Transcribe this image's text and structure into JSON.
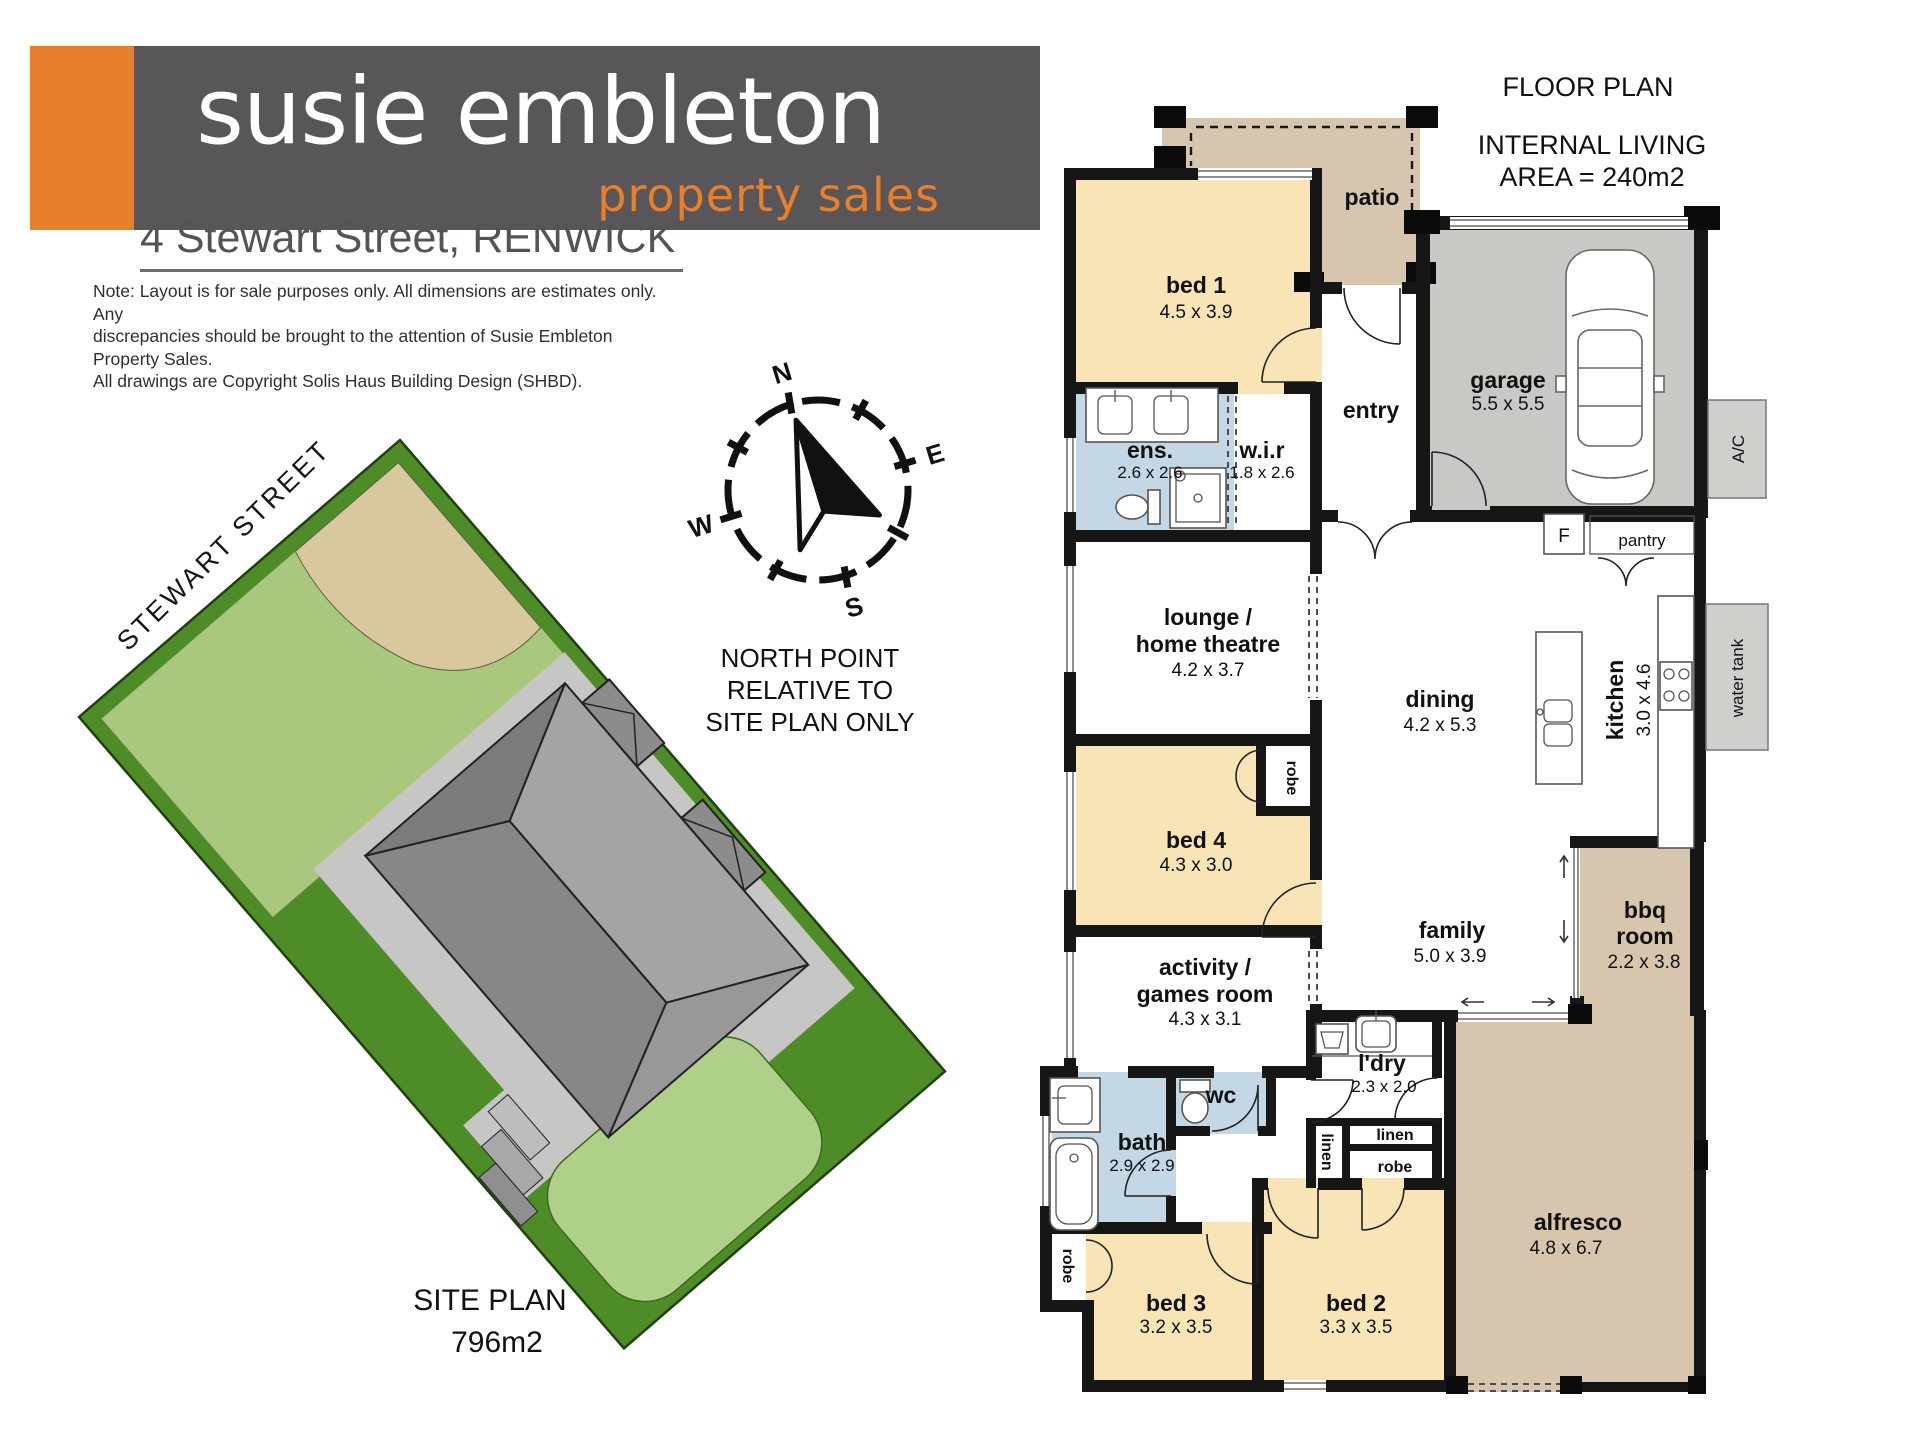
{
  "brand": {
    "line1": "susie embleton",
    "line2": "property sales"
  },
  "address": "4 Stewart Street, RENWICK",
  "note": {
    "line1": "Note: Layout is for sale purposes only. All dimensions are estimates only. Any",
    "line2": "discrepancies should be brought to the attention of Susie Embleton Property Sales.",
    "line3": "All drawings are Copyright Solis Haus Building Design (SHBD)."
  },
  "floor_plan": {
    "title": "FLOOR PLAN",
    "area_line1": "INTERNAL LIVING",
    "area_line2": "AREA = 240m2",
    "rooms": {
      "patio": {
        "label": "patio"
      },
      "bed1": {
        "label": "bed 1",
        "dims": "4.5 x 3.9"
      },
      "ens": {
        "label": "ens.",
        "dims": "2.6 x 2.6"
      },
      "wir": {
        "label": "w.i.r",
        "dims": "1.8 x 2.6"
      },
      "entry": {
        "label": "entry"
      },
      "garage": {
        "label": "garage",
        "dims": "5.5 x 5.5"
      },
      "ac": {
        "label": "A/C"
      },
      "fridge": {
        "label": "F"
      },
      "pantry": {
        "label": "pantry"
      },
      "kitchen": {
        "label": "kitchen",
        "dims": "3.0 x 4.6"
      },
      "water_tank": {
        "label": "water tank"
      },
      "lounge": {
        "label1": "lounge /",
        "label2": "home theatre",
        "dims": "4.2 x 3.7"
      },
      "dining": {
        "label": "dining",
        "dims": "4.2 x 5.3"
      },
      "bed4": {
        "label": "bed 4",
        "dims": "4.3 x 3.0"
      },
      "robe_bed4": {
        "label": "robe"
      },
      "family": {
        "label": "family",
        "dims": "5.0 x 3.9"
      },
      "bbq": {
        "label1": "bbq",
        "label2": "room",
        "dims": "2.2 x 3.8"
      },
      "activity": {
        "label1": "activity /",
        "label2": "games room",
        "dims": "4.3 x 3.1"
      },
      "ldry": {
        "label": "l'dry",
        "dims": "2.3 x 2.0"
      },
      "bath": {
        "label": "bath",
        "dims": "2.9 x 2.9"
      },
      "wc": {
        "label": "wc"
      },
      "linen_tall": {
        "label": "linen"
      },
      "linen": {
        "label": "linen"
      },
      "robe_hall": {
        "label": "robe"
      },
      "robe_bed3": {
        "label": "robe"
      },
      "bed3": {
        "label": "bed 3",
        "dims": "3.2 x 3.5"
      },
      "bed2": {
        "label": "bed 2",
        "dims": "3.3 x 3.5"
      },
      "alfresco": {
        "label": "alfresco",
        "dims": "4.8 x 6.7"
      }
    }
  },
  "compass": {
    "n": "N",
    "e": "E",
    "s": "S",
    "w": "W",
    "caption1": "NORTH POINT",
    "caption2": "RELATIVE TO",
    "caption3": "SITE PLAN ONLY"
  },
  "site_plan": {
    "street": "STEWART STREET",
    "title": "SITE PLAN",
    "area": "796m2"
  },
  "colors": {
    "brand_orange": "#e87f2a",
    "logo_gray": "#585659",
    "bedroom_cream": "#f9e4b5",
    "wet_blue": "#c3d7e5",
    "outdoor_tan": "#d5c6ad",
    "garage_gray": "#c8c8c5",
    "lot_green": "#4e8c28",
    "front_lawn": "#a9c87e",
    "back_lawn": "#aed089",
    "sand": "#d8c89e",
    "wall_black": "#161616"
  }
}
